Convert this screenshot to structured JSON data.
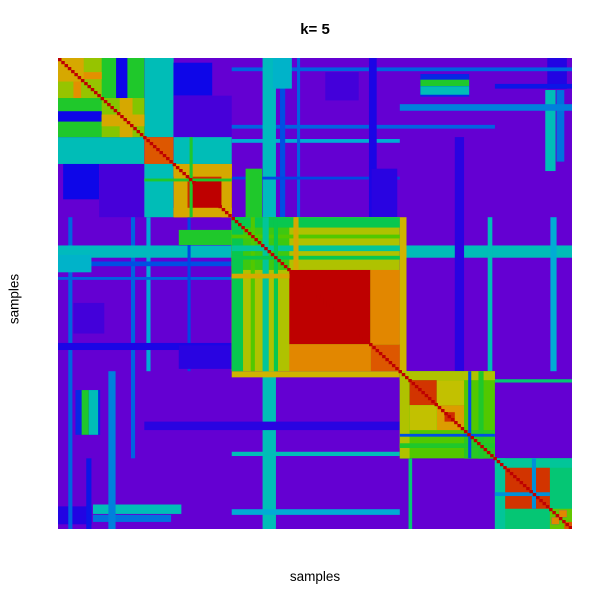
{
  "chart_data": {
    "type": "heatmap",
    "title": "k= 5",
    "xlabel": "samples",
    "ylabel": "samples",
    "k": 5,
    "description": "Consensus clustering matrix heatmap for k=5; symmetric sample-by-sample consensus values, low=violet high=red, five blocks along the red diagonal",
    "value_range": [
      0,
      1
    ],
    "base_value": 0.0,
    "legend": "none",
    "grid": "off",
    "colors": {
      "background": "#FFFFFF",
      "low": "#6400D2",
      "high": "#BE0000",
      "diagonal": "#BE0000",
      "title_text": "#000000"
    },
    "colormap_stops": [
      [
        0.0,
        "#6400D2"
      ],
      [
        0.08,
        "#4300DA"
      ],
      [
        0.16,
        "#0E06E8"
      ],
      [
        0.24,
        "#0048E4"
      ],
      [
        0.32,
        "#0080DC"
      ],
      [
        0.4,
        "#00ACD4"
      ],
      [
        0.47,
        "#00C4AC"
      ],
      [
        0.53,
        "#0AC83C"
      ],
      [
        0.6,
        "#52C800"
      ],
      [
        0.68,
        "#96C400"
      ],
      [
        0.76,
        "#C8C000"
      ],
      [
        0.84,
        "#E39000"
      ],
      [
        0.91,
        "#DC4E00"
      ],
      [
        1.0,
        "#BE0000"
      ]
    ],
    "cluster_boundaries": [
      0,
      0.168,
      0.338,
      0.665,
      0.85,
      1.0
    ],
    "cluster_sizes_fraction": [
      0.168,
      0.17,
      0.327,
      0.185,
      0.15
    ],
    "matrix_blocks": [
      {
        "x": [
          0.168,
          0.225
        ],
        "y": [
          0.0,
          0.168
        ],
        "v": 0.45
      },
      {
        "x": [
          0.225,
          0.3
        ],
        "y": [
          0.01,
          0.08
        ],
        "v": 0.16
      },
      {
        "x": [
          0.225,
          0.338
        ],
        "y": [
          0.08,
          0.168
        ],
        "v": 0.07
      },
      {
        "x": [
          0.52,
          0.585
        ],
        "y": [
          0.03,
          0.09
        ],
        "v": 0.08
      },
      {
        "x": [
          0.705,
          0.8
        ],
        "y": [
          0.034,
          0.082
        ],
        "v": 0.2
      },
      {
        "x": [
          0.705,
          0.8
        ],
        "y": [
          0.046,
          0.06
        ],
        "v": 0.55
      },
      {
        "x": [
          0.705,
          0.8
        ],
        "y": [
          0.06,
          0.078
        ],
        "v": 0.45
      },
      {
        "x": [
          0.952,
          0.99
        ],
        "y": [
          0.0,
          0.065
        ],
        "v": 0.13
      },
      {
        "x": [
          0.948,
          0.968
        ],
        "y": [
          0.068,
          0.24
        ],
        "v": 0.45
      },
      {
        "x": [
          0.97,
          0.985
        ],
        "y": [
          0.068,
          0.22
        ],
        "v": 0.3
      },
      {
        "x": [
          0.02,
          0.028
        ],
        "y": [
          0.338,
          1.0
        ],
        "v": 0.28
      },
      {
        "x": [
          0.055,
          0.065
        ],
        "y": [
          0.85,
          1.0
        ],
        "v": 0.18
      },
      {
        "x": [
          0.098,
          0.112
        ],
        "y": [
          0.665,
          1.0
        ],
        "v": 0.32
      },
      {
        "x": [
          0.142,
          0.15
        ],
        "y": [
          0.338,
          0.85
        ],
        "v": 0.28
      },
      {
        "x": [
          0.172,
          0.18
        ],
        "y": [
          0.338,
          0.665
        ],
        "v": 0.4
      },
      {
        "x": [
          0.398,
          0.424
        ],
        "y": [
          0.0,
          0.338
        ],
        "v": 0.44
      },
      {
        "x": [
          0.398,
          0.424
        ],
        "y": [
          0.665,
          1.0
        ],
        "v": 0.45
      },
      {
        "x": [
          0.432,
          0.442
        ],
        "y": [
          0.0,
          0.338
        ],
        "v": 0.25
      },
      {
        "x": [
          0.465,
          0.471
        ],
        "y": [
          0.0,
          0.338
        ],
        "v": 0.28
      },
      {
        "x": [
          0.252,
          0.258
        ],
        "y": [
          0.338,
          0.665
        ],
        "v": 0.24
      },
      {
        "x": [
          0.605,
          0.62
        ],
        "y": [
          0.0,
          0.338
        ],
        "v": 0.14
      },
      {
        "x": [
          0.665,
          0.678
        ],
        "y": [
          0.338,
          0.665
        ],
        "v": 0.78
      },
      {
        "x": [
          0.682,
          0.689
        ],
        "y": [
          0.85,
          1.0
        ],
        "v": 0.5
      },
      {
        "x": [
          0.772,
          0.79
        ],
        "y": [
          0.168,
          0.665
        ],
        "v": 0.12
      },
      {
        "x": [
          0.836,
          0.845
        ],
        "y": [
          0.338,
          0.665
        ],
        "v": 0.45
      },
      {
        "x": [
          0.958,
          0.97
        ],
        "y": [
          0.338,
          0.665
        ],
        "v": 0.4
      },
      {
        "x": [
          0.0,
          0.065
        ],
        "y": [
          0.418,
          0.455
        ],
        "v": 0.42
      },
      {
        "x": [
          0.235,
          0.346
        ],
        "y": [
          0.61,
          0.66
        ],
        "v": 0.12
      },
      {
        "x": [
          0.235,
          0.346
        ],
        "y": [
          0.365,
          0.397
        ],
        "v": 0.55
      },
      {
        "x": [
          0.0,
          0.168
        ],
        "y": [
          0.0,
          0.168
        ],
        "v": 0.55
      },
      {
        "x": [
          0.0,
          0.085
        ],
        "y": [
          0.0,
          0.085
        ],
        "v": 0.68
      },
      {
        "x": [
          0.085,
          0.168
        ],
        "y": [
          0.085,
          0.168
        ],
        "v": 0.66
      },
      {
        "x": [
          0.113,
          0.135
        ],
        "y": [
          0.0,
          0.085
        ],
        "v": 0.16
      },
      {
        "x": [
          0.03,
          0.045
        ],
        "y": [
          0.0,
          0.085
        ],
        "v": 0.84
      },
      {
        "x": [
          0.0,
          0.05
        ],
        "y": [
          0.0,
          0.05
        ],
        "v": 0.8
      },
      {
        "x": [
          0.12,
          0.145
        ],
        "y": [
          0.085,
          0.168
        ],
        "v": 0.8
      },
      {
        "x": [
          0.168,
          0.225
        ],
        "y": [
          0.168,
          0.225
        ],
        "v": 0.9
      },
      {
        "x": [
          0.225,
          0.338
        ],
        "y": [
          0.225,
          0.338
        ],
        "v": 0.95
      },
      {
        "x": [
          0.168,
          0.225
        ],
        "y": [
          0.225,
          0.338
        ],
        "v": 0.45
      },
      {
        "x": [
          0.225,
          0.252
        ],
        "y": [
          0.225,
          0.338
        ],
        "v": 0.8
      },
      {
        "x": [
          0.26,
          0.332
        ],
        "y": [
          0.26,
          0.332
        ],
        "v": 1.0
      },
      {
        "x": [
          0.225,
          0.338
        ],
        "y": [
          0.318,
          0.338
        ],
        "v": 0.8
      },
      {
        "x": [
          0.256,
          0.262
        ],
        "y": [
          0.168,
          0.338
        ],
        "v": 0.55
      },
      {
        "x": [
          0.338,
          0.665
        ],
        "y": [
          0.338,
          0.665
        ],
        "v": 0.72
      },
      {
        "x": [
          0.338,
          0.45
        ],
        "y": [
          0.338,
          0.45
        ],
        "v": 0.58
      },
      {
        "x": [
          0.338,
          0.36
        ],
        "y": [
          0.338,
          0.665
        ],
        "v": 0.52
      },
      {
        "x": [
          0.375,
          0.383
        ],
        "y": [
          0.338,
          0.665
        ],
        "v": 0.6
      },
      {
        "x": [
          0.398,
          0.41
        ],
        "y": [
          0.338,
          0.665
        ],
        "v": 0.48
      },
      {
        "x": [
          0.42,
          0.428
        ],
        "y": [
          0.338,
          0.665
        ],
        "v": 0.52
      },
      {
        "x": [
          0.45,
          0.608
        ],
        "y": [
          0.45,
          0.608
        ],
        "v": 1.0
      },
      {
        "x": [
          0.608,
          0.665
        ],
        "y": [
          0.608,
          0.665
        ],
        "v": 0.9
      },
      {
        "x": [
          0.45,
          0.608
        ],
        "y": [
          0.608,
          0.665
        ],
        "v": 0.85
      },
      {
        "x": [
          0.458,
          0.468
        ],
        "y": [
          0.338,
          0.45
        ],
        "v": 0.8
      },
      {
        "x": [
          0.665,
          0.85
        ],
        "y": [
          0.665,
          0.85
        ],
        "v": 0.6
      },
      {
        "x": [
          0.665,
          0.684
        ],
        "y": [
          0.665,
          0.85
        ],
        "v": 0.72
      },
      {
        "x": [
          0.684,
          0.737
        ],
        "y": [
          0.684,
          0.737
        ],
        "v": 0.94
      },
      {
        "x": [
          0.737,
          0.79
        ],
        "y": [
          0.737,
          0.79
        ],
        "v": 0.82
      },
      {
        "x": [
          0.684,
          0.737
        ],
        "y": [
          0.737,
          0.79
        ],
        "v": 0.75
      },
      {
        "x": [
          0.752,
          0.772
        ],
        "y": [
          0.752,
          0.772
        ],
        "v": 0.95
      },
      {
        "x": [
          0.79,
          0.85
        ],
        "y": [
          0.79,
          0.85
        ],
        "v": 0.56
      },
      {
        "x": [
          0.818,
          0.828
        ],
        "y": [
          0.665,
          0.85
        ],
        "v": 0.55
      },
      {
        "x": [
          0.798,
          0.804
        ],
        "y": [
          0.665,
          0.85
        ],
        "v": 0.25
      },
      {
        "x": [
          0.85,
          1.0
        ],
        "y": [
          0.85,
          1.0
        ],
        "v": 0.5
      },
      {
        "x": [
          0.85,
          0.87
        ],
        "y": [
          0.85,
          1.0
        ],
        "v": 0.48
      },
      {
        "x": [
          0.87,
          0.957
        ],
        "y": [
          0.87,
          0.957
        ],
        "v": 0.94
      },
      {
        "x": [
          0.922,
          0.93
        ],
        "y": [
          0.85,
          0.957
        ],
        "v": 0.35
      },
      {
        "x": [
          0.957,
          1.0
        ],
        "y": [
          0.957,
          1.0
        ],
        "v": 0.62
      },
      {
        "x": [
          0.96,
          0.975
        ],
        "y": [
          0.975,
          0.99
        ],
        "v": 0.3
      },
      {
        "x": [
          0.975,
          0.99
        ],
        "y": [
          0.96,
          0.975
        ],
        "v": 0.85
      },
      {
        "x": [
          0.985,
          1.0
        ],
        "y": [
          0.985,
          1.0
        ],
        "v": 0.9
      }
    ],
    "diagonal": {
      "value": 1.0,
      "width": 0.0068,
      "steps": 157
    }
  }
}
